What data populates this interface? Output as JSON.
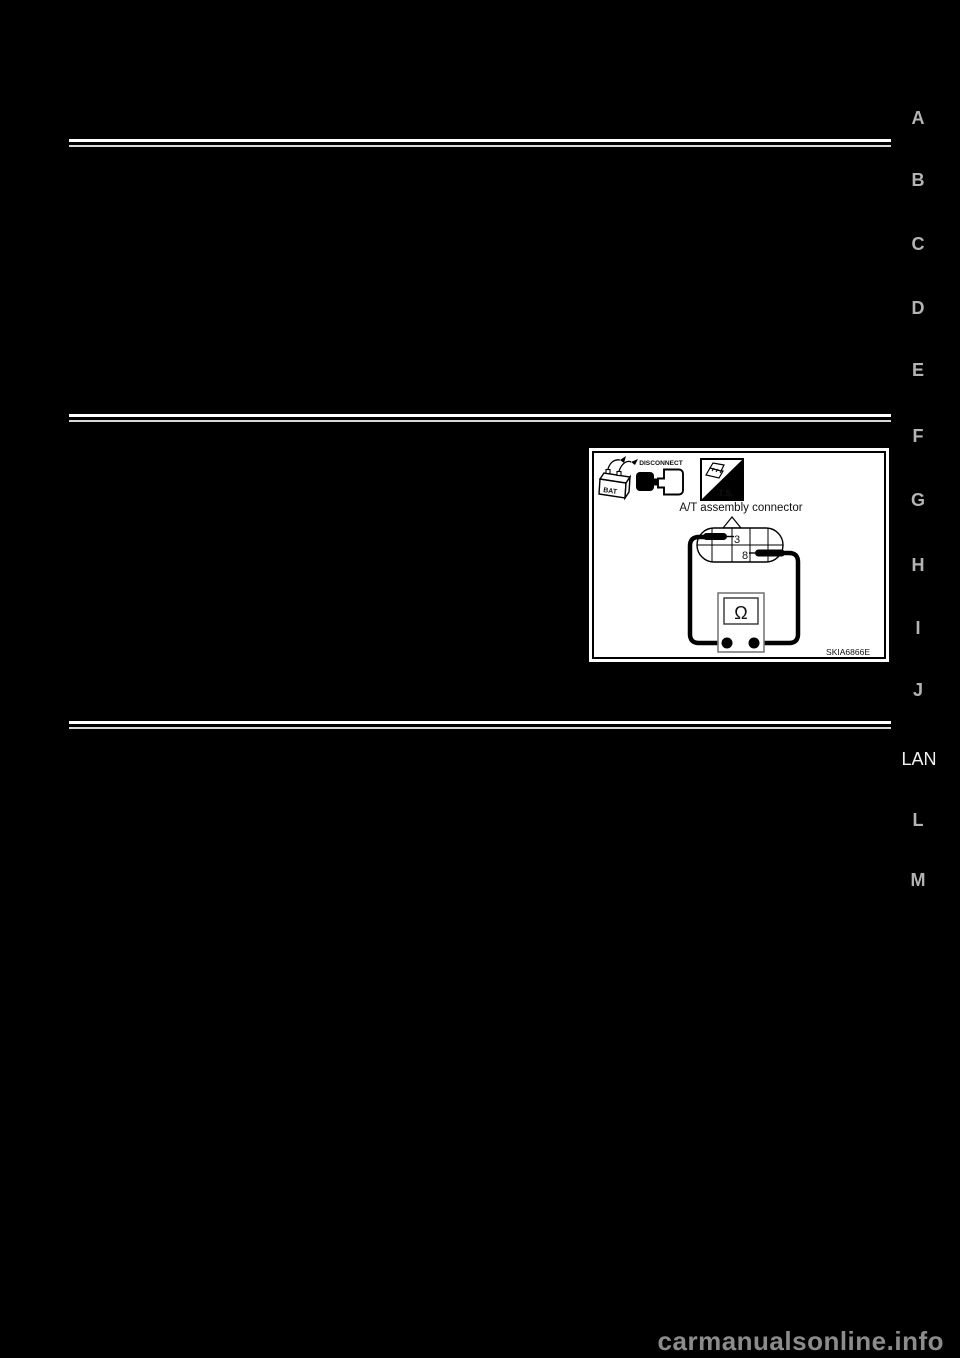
{
  "page": {
    "watermark": "carmanualsonline.info"
  },
  "section_index": {
    "letters": [
      "A",
      "B",
      "C",
      "D",
      "E",
      "F",
      "G",
      "H",
      "I",
      "J",
      "L",
      "M"
    ],
    "current_section": "LAN"
  },
  "figure": {
    "caption": "A/T assembly connector",
    "figure_code": "SKIA6866E",
    "battery_icon_label": "BAT",
    "disconnect_icon_label": "DISCONNECT",
    "test_switch_icon_label": "T.S.",
    "pin_top": "3",
    "pin_bottom": "8",
    "meter_symbol": "Ω"
  },
  "colors": {
    "page_background": "#000000",
    "rule_line": "#ffffff",
    "section_letter": "#b4b4b4",
    "current_section": "#f2f2f2",
    "figure_background": "#ffffff",
    "line_art": "#000000",
    "watermark": "#8c8c8c"
  }
}
